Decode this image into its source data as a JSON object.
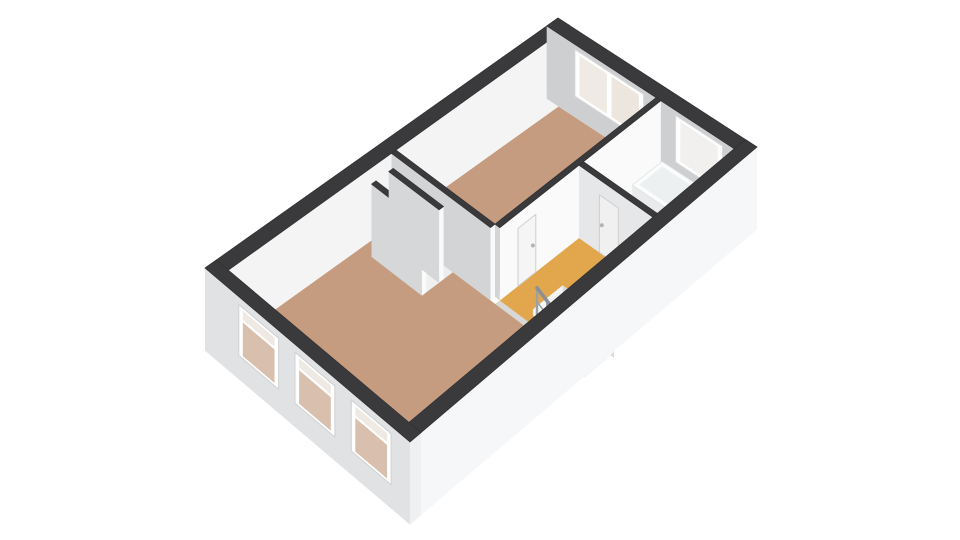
{
  "canvas": {
    "width": 960,
    "height": 540,
    "background": "#ffffff"
  },
  "projection": {
    "cornerW": [
      205,
      268
    ],
    "cornerN": [
      558,
      18
    ],
    "cornerS": [
      410,
      442
    ],
    "cornerE": [
      757,
      147
    ],
    "planW": 9.4,
    "planH": 5.1,
    "inset": 0.3,
    "heightScale": 28,
    "wallTopZ": 2.6
  },
  "palette": {
    "wall_top": "#3a3a3c",
    "wall_white_face": "#fafafa",
    "wall_gray_face": "#d2d4d5",
    "exterior_sw_facade": "#e0e2e4",
    "exterior_se_facade": "#f6f7f8",
    "floor_wood": "#c59c7f",
    "floor_landing": "#e2a74d",
    "floor_bathroom": "#eceeef",
    "glass_warm": "#d9c0ae",
    "toilet_blue": "#bcd1df"
  },
  "rooms": [
    {
      "name": "living-room",
      "floor": "wood"
    },
    {
      "name": "bedroom",
      "floor": "wood"
    },
    {
      "name": "landing-stairwell",
      "floor": "orange"
    },
    {
      "name": "bathroom",
      "floor": "light"
    },
    {
      "name": "closets",
      "floor": "light"
    }
  ],
  "scene": [
    {
      "type": "floor",
      "name": "living-room-floor",
      "rect": [
        0,
        0,
        4.35,
        4.5
      ],
      "fill": "#c59c7f"
    },
    {
      "type": "floor",
      "name": "bedroom-floor",
      "rect": [
        4.47,
        0,
        8.8,
        2.5
      ],
      "fill": "#c59c7f"
    },
    {
      "type": "floor",
      "name": "bathroom-floor",
      "rect": [
        6.72,
        2.62,
        8.8,
        4.5
      ],
      "fill": "#eceeef"
    },
    {
      "type": "floorPoly",
      "name": "landing-floor",
      "points": [
        [
          4.35,
          2.62
        ],
        [
          6.6,
          2.62
        ],
        [
          6.6,
          4.5
        ],
        [
          5.55,
          4.5
        ],
        [
          5.55,
          3.2
        ],
        [
          4.75,
          3.2
        ],
        [
          4.75,
          4.5
        ],
        [
          4.35,
          4.5
        ]
      ],
      "fill": "#e2a74d"
    },
    {
      "type": "floor",
      "name": "threshold-strip",
      "rect": [
        4.35,
        2.62,
        4.47,
        4.5
      ],
      "fill": "#d8d8d8"
    },
    {
      "type": "box",
      "name": "exterior-wall-nw",
      "box": [
        -0.3,
        -0.3,
        9.1,
        0
      ],
      "zb": 0,
      "zt": 2.6,
      "top": "#3a3a3c",
      "faceY": "#f4f4f5"
    },
    {
      "type": "box",
      "name": "exterior-wall-ne",
      "box": [
        8.8,
        -0.3,
        9.1,
        4.8
      ],
      "zb": 0,
      "zt": 2.6,
      "top": "#3a3a3c",
      "faceX": "#cdcfd1"
    },
    {
      "type": "panel",
      "name": "bedroom-window-frame",
      "plane": "x",
      "at": 8.8,
      "u": [
        0.42,
        2.18
      ],
      "z": [
        0.75,
        2.42
      ],
      "fill": "#ffffff",
      "stroke": "#d9d9d9"
    },
    {
      "type": "panel",
      "name": "bedroom-window-glass-left",
      "plane": "x",
      "at": 8.8,
      "u": [
        0.54,
        1.24
      ],
      "z": [
        0.87,
        2.3
      ],
      "fill": "#efeae4"
    },
    {
      "type": "panel",
      "name": "bedroom-window-glass-right",
      "plane": "x",
      "at": 8.8,
      "u": [
        1.36,
        2.06
      ],
      "z": [
        0.87,
        2.3
      ],
      "fill": "#ece6df"
    },
    {
      "type": "panel",
      "name": "bathroom-window-frame",
      "plane": "x",
      "at": 8.8,
      "u": [
        3.0,
        4.2
      ],
      "z": [
        0.75,
        2.42
      ],
      "fill": "#ffffff",
      "stroke": "#d9d9d9"
    },
    {
      "type": "panel",
      "name": "bathroom-window-glass",
      "plane": "x",
      "at": 8.8,
      "u": [
        3.12,
        4.08
      ],
      "z": [
        0.87,
        2.3
      ],
      "fill": "#f1f0ee"
    },
    {
      "type": "box",
      "name": "wall-bedroom-landing",
      "box": [
        4.47,
        2.5,
        8.8,
        2.62
      ],
      "zb": 0,
      "zt": 2.6,
      "top": "#3a3a3c",
      "faceX": "#d2d4d5",
      "faceY": "#fafafa"
    },
    {
      "type": "panel",
      "name": "bedroom-door",
      "plane": "y",
      "at": 2.62,
      "u": [
        4.96,
        5.44
      ],
      "z": [
        0,
        2.06
      ],
      "fill": "#f5f5f5",
      "stroke": "#cfcfcf"
    },
    {
      "type": "knob",
      "name": "bedroom-door-handle",
      "p": [
        5.36,
        2.62,
        1.03
      ],
      "r": 2,
      "fill": "#b3b3b3"
    },
    {
      "type": "block",
      "name": "bathtub",
      "box": [
        7.95,
        2.7,
        8.75,
        4.35
      ],
      "h": 0.55,
      "top": "#fbfcfc",
      "inner": "#edf0f1",
      "faceX": "#e8eaeb",
      "faceY": "#f3f4f5",
      "stroke": "#dfe2e3"
    },
    {
      "type": "block",
      "name": "sink-vanity",
      "box": [
        6.78,
        2.72,
        7.5,
        3.18
      ],
      "h": 0.88,
      "top": "#fcfcfd",
      "inner": "#eceff0",
      "faceX": "#eff1f2",
      "faceY": "#f7f8f8",
      "stroke": "#e0e3e4"
    },
    {
      "type": "block",
      "name": "toilet",
      "box": [
        6.78,
        3.55,
        7.2,
        4.12
      ],
      "h": 0.42,
      "top": "#bcd1df",
      "inner": "#b0c8d8",
      "faceX": "#a9c3d4",
      "faceY": "#b4ccdb",
      "stroke": "#9fb9cb"
    },
    {
      "type": "floor",
      "name": "closet-floor-left",
      "rect": [
        3.64,
        0.28,
        3.98,
        1.55
      ],
      "fill": "#f0f0f0"
    },
    {
      "type": "floor",
      "name": "closet-floor-right",
      "rect": [
        4.1,
        0.28,
        4.35,
        1.55
      ],
      "fill": "#ededee"
    },
    {
      "type": "box",
      "name": "wall-living-bedroom",
      "box": [
        4.35,
        0,
        4.47,
        2.5
      ],
      "zb": 0,
      "zt": 2.6,
      "top": "#3a3a3c",
      "faceX": "#d2d4d5",
      "faceY": "#fafafa"
    },
    {
      "type": "box",
      "name": "closet-wall-left",
      "box": [
        3.52,
        0.28,
        3.64,
        1.55
      ],
      "zb": 0,
      "zt": 2.6,
      "top": "#3a3a3c",
      "faceX": "#d5d7d8",
      "faceY": "#fafafa"
    },
    {
      "type": "box",
      "name": "closet-wall-mid",
      "box": [
        3.98,
        0.28,
        4.1,
        1.55
      ],
      "zb": 0,
      "zt": 2.6,
      "top": "#3a3a3c",
      "faceX": "#d5d7d8",
      "faceY": "#fafafa"
    },
    {
      "type": "box",
      "name": "wall-landing-bathroom",
      "box": [
        6.6,
        2.62,
        6.72,
        4.5
      ],
      "zb": 0,
      "zt": 2.6,
      "top": "#3a3a3c",
      "faceX": "#e6e7e8",
      "faceY": "#f6f6f7"
    },
    {
      "type": "panel",
      "name": "bathroom-door",
      "plane": "x",
      "at": 6.6,
      "u": [
        3.14,
        3.62
      ],
      "z": [
        0,
        2.06
      ],
      "fill": "#f0f0f0",
      "stroke": "#cfcfcf"
    },
    {
      "type": "knob",
      "name": "bathroom-door-handle",
      "p": [
        6.6,
        3.2,
        1.03
      ],
      "r": 2,
      "fill": "#b3b3b3"
    },
    {
      "type": "stairs",
      "name": "staircase",
      "x": [
        4.75,
        5.55
      ],
      "yStart": 3.2,
      "treads": 5,
      "treadDepth": 0.26,
      "stepDrop": 0.21,
      "tread": "#ffffff",
      "riser": "#f4f5f5",
      "treadStroke": "#e0e0e0",
      "shaft": "#d9dadb"
    },
    {
      "type": "railing",
      "name": "stair-railing",
      "x": 4.79,
      "y0": 3.26,
      "dy": 0.26,
      "count": 5,
      "postHeight": 1.0,
      "stepDrop": 0.21,
      "baluster": "#9aa1a6",
      "rail": "#8a9196"
    },
    {
      "type": "box",
      "name": "exterior-wall-se",
      "box": [
        -0.3,
        4.5,
        9.1,
        4.8
      ],
      "zb": -0.35,
      "zt": 2.6,
      "top": "#3a3a3c",
      "faceY": "#f6f7f8"
    },
    {
      "type": "box",
      "name": "exterior-wall-sw",
      "box": [
        -0.3,
        -0.3,
        0,
        4.8
      ],
      "zb": -0.35,
      "zt": 2.6,
      "top": "#3a3a3c",
      "faceX": "#e0e2e4",
      "faceY": "#eef0f1"
    },
    {
      "type": "panel",
      "name": "facade-window-1-frame",
      "plane": "x",
      "at": -0.3,
      "u": [
        0.54,
        1.53
      ],
      "z": [
        0.5,
        2.32
      ],
      "fill": "#ffffff",
      "stroke": "#cfd1d2"
    },
    {
      "type": "panel",
      "name": "facade-window-1-glass-top",
      "plane": "x",
      "at": -0.3,
      "u": [
        0.64,
        1.43
      ],
      "z": [
        1.9,
        2.22
      ],
      "fill": "#efe9e3"
    },
    {
      "type": "panel",
      "name": "facade-window-1-glass-bottom",
      "plane": "x",
      "at": -0.3,
      "u": [
        0.64,
        1.43
      ],
      "z": [
        0.6,
        1.8
      ],
      "fill": "#d9c0ae"
    },
    {
      "type": "panel",
      "name": "facade-window-2-frame",
      "plane": "x",
      "at": -0.3,
      "u": [
        1.94,
        2.93
      ],
      "z": [
        0.5,
        2.32
      ],
      "fill": "#ffffff",
      "stroke": "#cfd1d2"
    },
    {
      "type": "panel",
      "name": "facade-window-2-glass-top",
      "plane": "x",
      "at": -0.3,
      "u": [
        2.04,
        2.83
      ],
      "z": [
        1.9,
        2.22
      ],
      "fill": "#efe9e3"
    },
    {
      "type": "panel",
      "name": "facade-window-2-glass-bottom",
      "plane": "x",
      "at": -0.3,
      "u": [
        2.04,
        2.83
      ],
      "z": [
        0.6,
        1.8
      ],
      "fill": "#d9c0ae"
    },
    {
      "type": "panel",
      "name": "facade-window-3-frame",
      "plane": "x",
      "at": -0.3,
      "u": [
        3.34,
        4.33
      ],
      "z": [
        0.5,
        2.32
      ],
      "fill": "#ffffff",
      "stroke": "#cfd1d2"
    },
    {
      "type": "panel",
      "name": "facade-window-3-glass-top",
      "plane": "x",
      "at": -0.3,
      "u": [
        3.44,
        4.23
      ],
      "z": [
        1.9,
        2.22
      ],
      "fill": "#efe9e3"
    },
    {
      "type": "panel",
      "name": "facade-window-3-glass-bottom",
      "plane": "x",
      "at": -0.3,
      "u": [
        3.44,
        4.23
      ],
      "z": [
        0.6,
        1.8
      ],
      "fill": "#d9c0ae"
    }
  ]
}
